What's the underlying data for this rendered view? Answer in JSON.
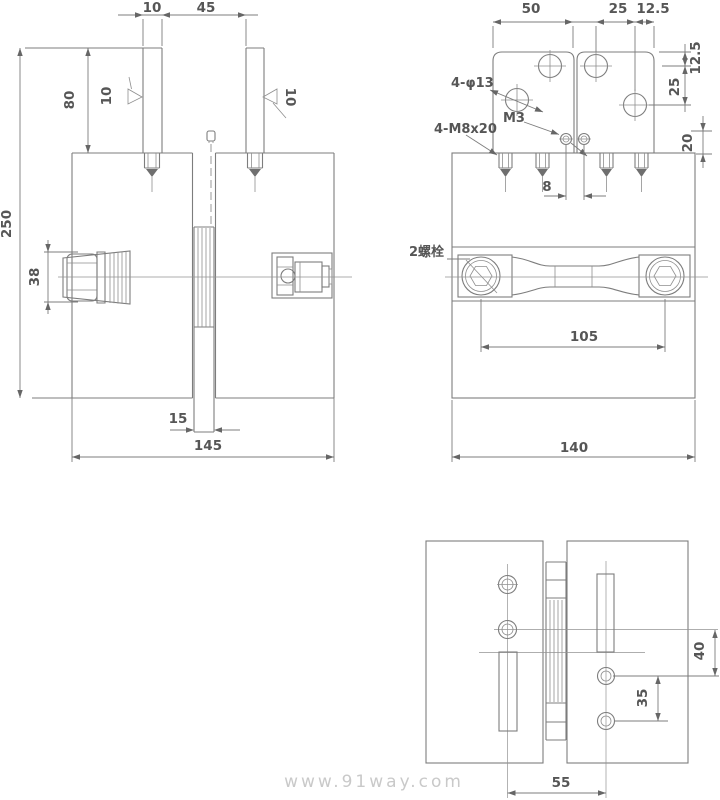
{
  "watermark": {
    "text": "www.91way.com"
  },
  "front_view": {
    "dim_rod_width": "10",
    "dim_rod_gap": "45",
    "dim_rod_length": "80",
    "finish_left": "10",
    "finish_right": "10",
    "dim_total_height": "250",
    "dim_gland_diameter": "38",
    "dim_blade_width": "15",
    "dim_total_width": "145"
  },
  "side_view": {
    "dim_plate_width": "50",
    "dim_hole_to_hole": "25",
    "dim_hole_to_edge": "12.5",
    "dim_top_to_hole": "12.5",
    "dim_hole_spacing_vertical": "25",
    "label_through_holes": "4-φ13",
    "label_set_screw": "M3",
    "label_studs": "4-M8x20",
    "dim_plate_thickness": "20",
    "dim_screw_spacing": "8",
    "label_bolts": "2螺栓",
    "dim_bolt_centers": "105",
    "dim_body_width": "140"
  },
  "bottom_view": {
    "dim_hole_offset": "40",
    "dim_hole_spacing": "35",
    "dim_center_distance": "55"
  }
}
